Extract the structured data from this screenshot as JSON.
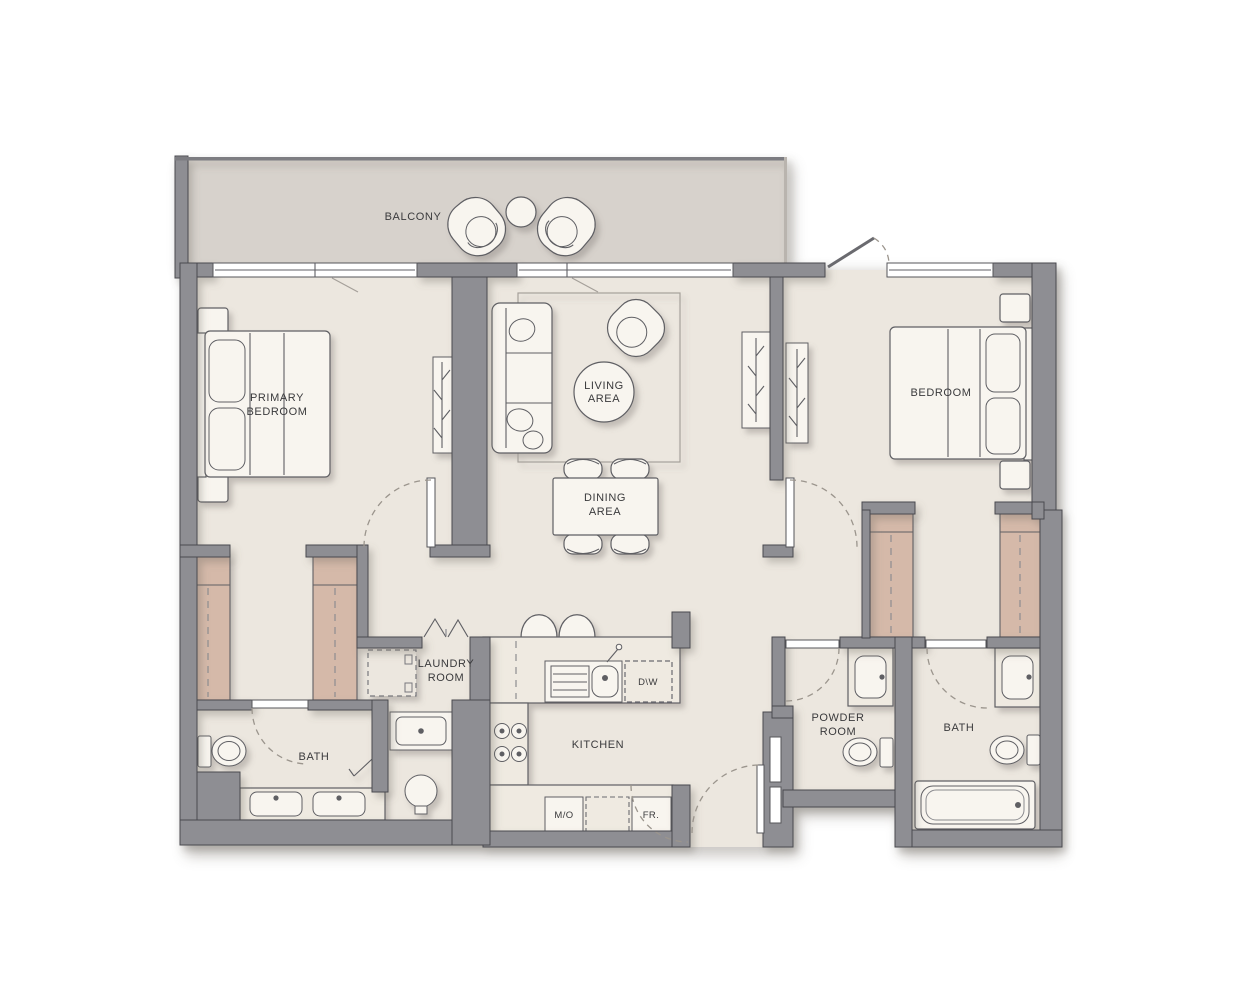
{
  "floorplan": {
    "rooms": {
      "balcony": {
        "label": "BALCONY"
      },
      "primary_bedroom": {
        "line1": "PRIMARY",
        "line2": "BEDROOM"
      },
      "living_area": {
        "line1": "LIVING",
        "line2": "AREA"
      },
      "dining_area": {
        "line1": "DINING",
        "line2": "AREA"
      },
      "bedroom": {
        "label": "BEDROOM"
      },
      "laundry_room": {
        "line1": "LAUNDRY",
        "line2": "ROOM"
      },
      "bath_primary": {
        "label": "BATH"
      },
      "kitchen": {
        "label": "KITCHEN"
      },
      "powder_room": {
        "line1": "POWDER",
        "line2": "ROOM"
      },
      "bath_secondary": {
        "label": "BATH"
      }
    },
    "appliances": {
      "dishwasher": {
        "label": "D\\W"
      },
      "microwave": {
        "label": "M/O"
      },
      "fridge": {
        "label": "FR."
      }
    },
    "colors": {
      "wall": "#8e8e93",
      "wall_edge": "#4a4a50",
      "floor": "#ece7df",
      "balcony_floor": "#d7d2cc",
      "furniture": "#f8f5ef",
      "line": "#5f5f64",
      "wardrobe": "#d5b9a9",
      "counter": "#efeae1",
      "text": "#3a3a3c",
      "dash": "#9b958d"
    }
  }
}
